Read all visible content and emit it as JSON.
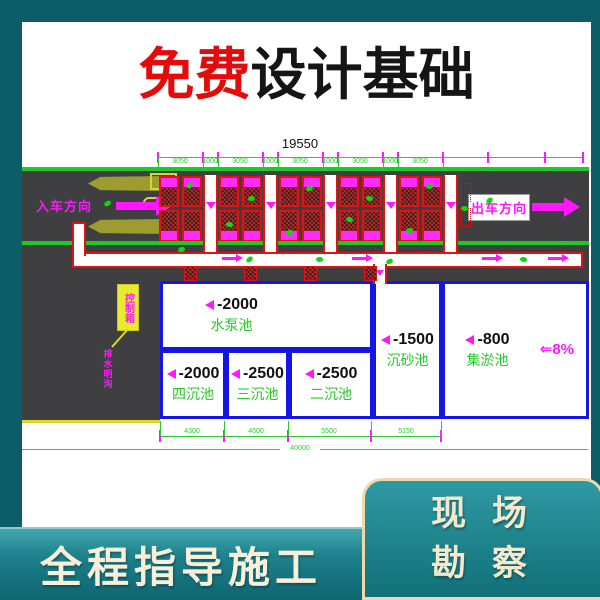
{
  "title": {
    "free": "免费",
    "rest": "设计基础"
  },
  "drawing": {
    "total_top": "19550",
    "segments_top": [
      "3050",
      "1000",
      "3050",
      "1000",
      "3050",
      "1000",
      "3050",
      "1000",
      "3050"
    ],
    "entry": "入车方向",
    "exit": "出车方向",
    "control_box": "控制箱",
    "drain": "排水明沟",
    "slope_arrow": "⇐",
    "slope_value": "8%",
    "pools": [
      {
        "depth": "-2000",
        "name": "水泵池"
      },
      {
        "depth": "-2000",
        "name": "四沉池"
      },
      {
        "depth": "-2500",
        "name": "三沉池"
      },
      {
        "depth": "-2500",
        "name": "二沉池"
      },
      {
        "depth": "-1500",
        "name": "沉砂池"
      },
      {
        "depth": "-800",
        "name": "集淤池"
      }
    ],
    "segments_bottom": [
      "4300",
      "4600",
      "5500",
      "5150"
    ],
    "total_bottom": "40000"
  },
  "banner": {
    "text": "全程指导施工"
  },
  "badge": {
    "line1": "现 场",
    "line2": "勘 察"
  },
  "colors": {
    "frame_teal": "#0d5d68",
    "accent_magenta": "#ff17ff",
    "cad_green": "#2ecc2e",
    "road_green": "#1fc829",
    "pool_blue": "#1515e8",
    "bay_red": "#e31212",
    "road_gray": "#3f3f41",
    "cream": "#f3e9cf",
    "title_red": "#e50b0b"
  }
}
